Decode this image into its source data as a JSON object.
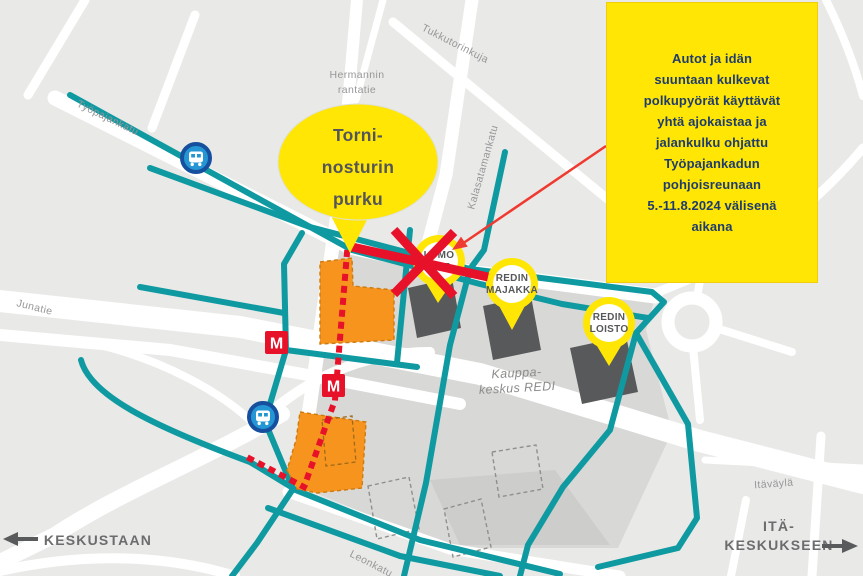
{
  "map": {
    "streets": {
      "tyopajankatu": "Työpajankatu",
      "hermannin_line1": "Hermannin",
      "hermannin_line2": "rantatie",
      "tukkutorinkuja": "Tukkutorinkuja",
      "kalasatamankatu": "Kalasatamankatu",
      "junatie": "Junatie",
      "itavayla": "Itäväylä",
      "leonkatu": "Leonkatu",
      "kauppakeskus_line1": "Kauppa-",
      "kauppakeskus_line2": "keskus REDI"
    },
    "pins": {
      "lumo": {
        "line1": "LUMO",
        "line2": "ONE"
      },
      "redin_majakka": {
        "line1": "REDIN",
        "line2": "MAJAKKA"
      },
      "redin_loisto": {
        "line1": "REDIN",
        "line2": "LOISTO"
      }
    },
    "metro_label": "M",
    "directions": {
      "west": "KESKUSTAAN",
      "east_line1": "ITÄ-",
      "east_line2": "KESKUKSEEN"
    }
  },
  "callout_bubble": {
    "lines": [
      "Torni-",
      "nosturin",
      "purku"
    ]
  },
  "info_box": {
    "lines": [
      "Autot ja idän",
      "suuntaan kulkevat",
      "polkupyörät käyttävät",
      "yhtä ajokaistaa ja",
      "jalankulku ohjattu",
      "Työpajankadun",
      "pohjoisreunaan",
      "5.-11.8.2024 välisenä",
      "aikana"
    ]
  },
  "colors": {
    "map_background": "#e9e9e7",
    "road_white": "#ffffff",
    "block_gray": "#d8d8d6",
    "building_gray": "#58595b",
    "route_teal": "#0f99a1",
    "construction_orange": "#f7941e",
    "alert_red": "#e8112a",
    "annotation_red": "#ef3a31",
    "highlight_yellow": "#ffe605",
    "info_text_navy": "#1f3c6e",
    "metro_red": "#e8112a",
    "transit_blue": "#2496d3"
  }
}
